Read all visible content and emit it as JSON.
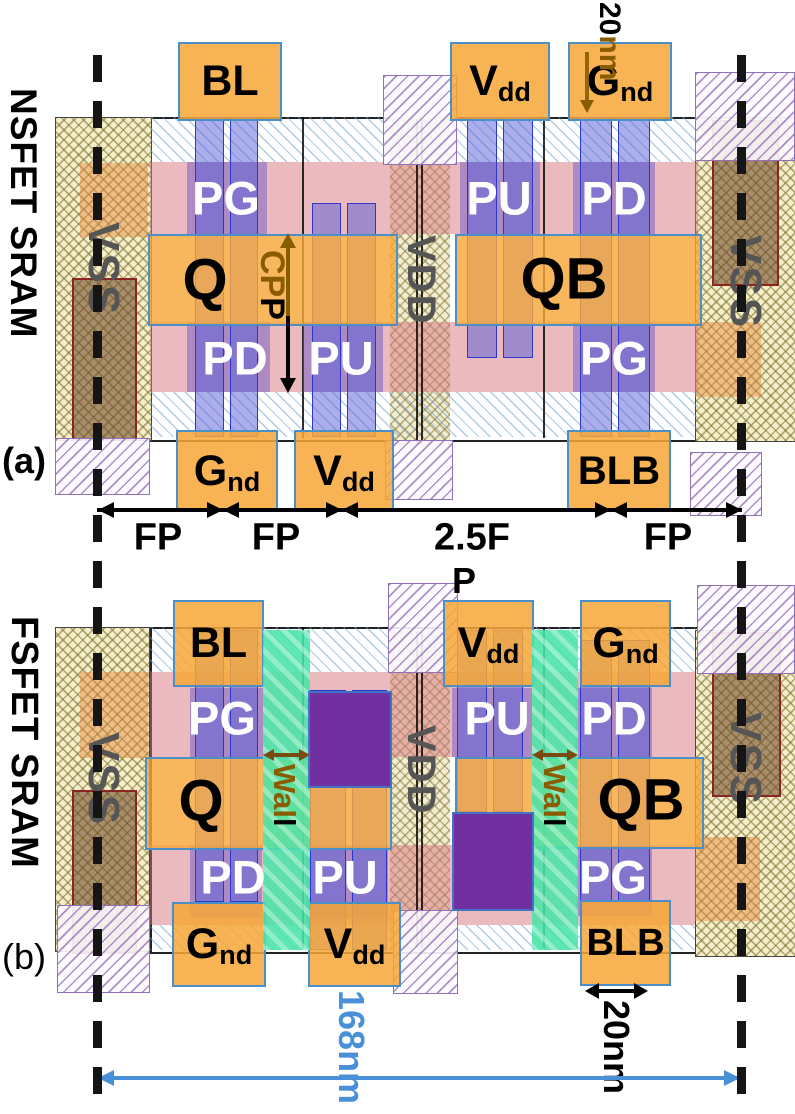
{
  "panel_a": {
    "title": "NSFET SRAM",
    "tag": "(a)",
    "rails": {
      "vss_left": "VSS",
      "vss_right": "VSS",
      "vdd": "VDD"
    },
    "gates": {
      "pg_top": "PG",
      "pu_top": "PU",
      "pd_top": "PD",
      "pd_bot": "PD",
      "pu_bot": "PU",
      "pg_bot": "PG"
    },
    "nodes": {
      "q": "Q",
      "qb": "QB"
    },
    "contacts": {
      "bl": "BL",
      "blb": "BLB",
      "vdd_main": "V",
      "vdd_sub": "dd",
      "gnd_main": "G",
      "gnd_sub": "nd"
    },
    "annotations": {
      "cpp_brown": "CP",
      "cpp_black": "P",
      "gate_len_black": "20",
      "gate_len_brown": "nm"
    },
    "dims": [
      "FP",
      "FP",
      "2.5F",
      "FP"
    ]
  },
  "panel_b": {
    "title": "FSFET SRAM",
    "tag": "(b)",
    "rails": {
      "vss_left": "VSS",
      "vss_right": "VSS",
      "vdd": "VDD"
    },
    "gates": {
      "pg_top": "PG",
      "pu_top": "PU",
      "pd_top": "PD",
      "pd_bot": "PD",
      "pu_bot": "PU",
      "pg_bot": "PG"
    },
    "nodes": {
      "q": "Q",
      "qb": "QB"
    },
    "contacts": {
      "bl": "BL",
      "blb": "BLB",
      "vdd_main": "V",
      "vdd_sub": "dd",
      "gnd_main": "G",
      "gnd_sub": "nd"
    },
    "walls": {
      "left_main": "Wal",
      "left_tail": "l",
      "right_main": "Wal",
      "right_tail": "l"
    },
    "annotations": {
      "p": "P",
      "cell_width": "168nm",
      "gate_len": "20nm"
    }
  },
  "colors": {
    "contact_orange": "#F6A738",
    "gate_blue": "#585ED8",
    "diffusion_pink": "#D97A86",
    "wall_green": "#48E4A8",
    "isolation_purple": "#7030A0",
    "rail_yellow": "#F6EEC9",
    "annot_brown": "#8A5C00",
    "dim_blue": "#4A90D9"
  }
}
